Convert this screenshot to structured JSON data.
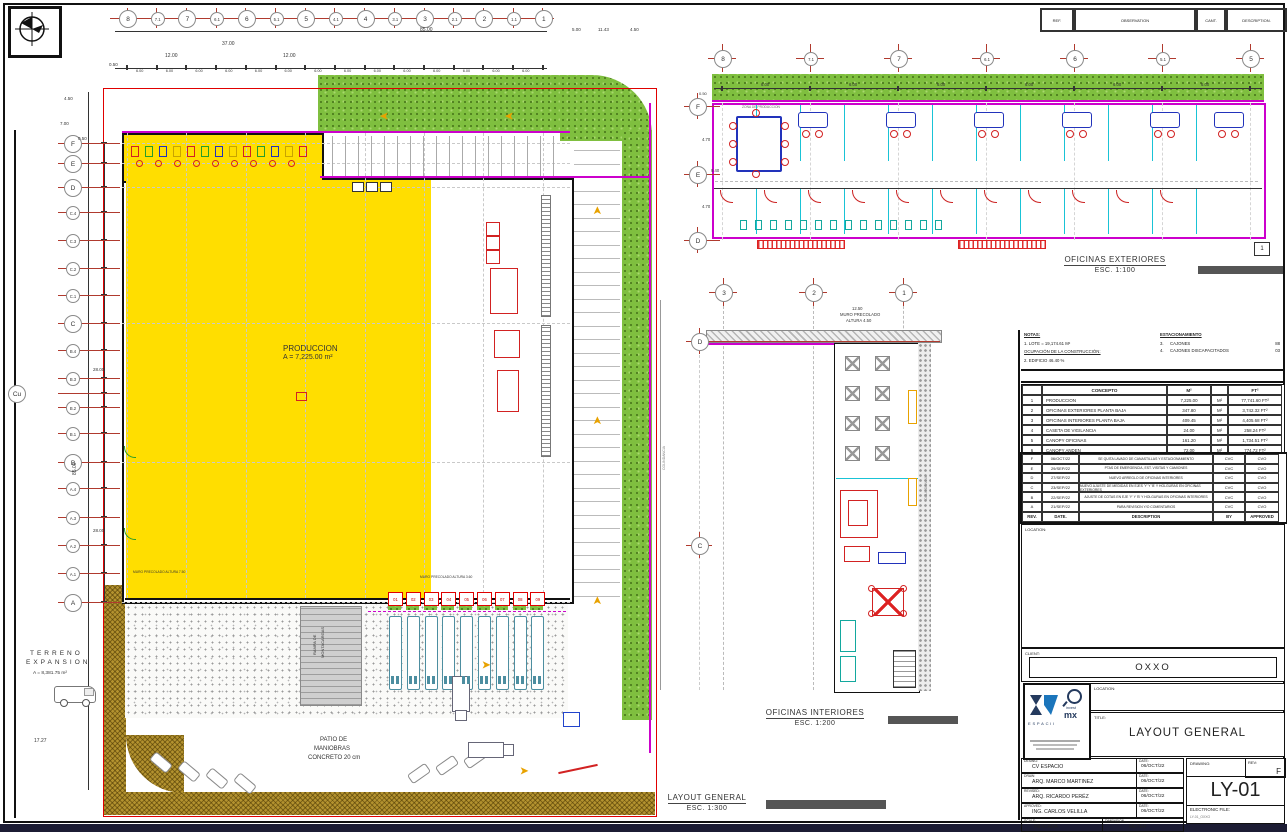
{
  "colors": {
    "production_yellow": "#ffde00",
    "landscape_green": "#7fbf3f",
    "road_brown": "#b3922f",
    "line_red": "#b03a2e",
    "wall_magenta": "#cc00cc",
    "partition_cyan": "#19c3d6",
    "furniture_blue": "#2233bb",
    "furniture_red": "#d22222",
    "bottom_bar": "#1c1c34"
  },
  "ref_header": {
    "ref": "REF.",
    "observation": "OBSERVATION",
    "cant": "CANT.",
    "description": "DESCRIPTION."
  },
  "plans": {
    "layout": {
      "title": "LAYOUT GENERAL",
      "scale": "ESC. 1:300"
    },
    "exterior": {
      "title": "OFICINAS EXTERIORES",
      "scale": "ESC. 1:100",
      "marker": "1"
    },
    "interior": {
      "title": "OFICINAS INTERIORES",
      "scale": "ESC. 1:200"
    }
  },
  "grids": {
    "layout_top": [
      "8",
      "7.1",
      "7",
      "6.1",
      "6",
      "5.1",
      "5",
      "4.1",
      "4",
      "3.1",
      "3",
      "2.1",
      "2",
      "1.1",
      "1"
    ],
    "layout_left": [
      "F",
      "E",
      "D",
      "C.4",
      "C.3",
      "C.2",
      "C.1",
      "C",
      "B.4",
      "B.3",
      "Cu",
      "B.2",
      "B.1",
      "B",
      "A.4",
      "A.3",
      "A.2",
      "A.1",
      "A"
    ],
    "exterior_top": [
      "8",
      "7.1",
      "7",
      "6.1",
      "6",
      "5.1",
      "5"
    ],
    "exterior_left": [
      "F",
      "E",
      "D"
    ],
    "interior_top": [
      "3",
      "2",
      "1"
    ],
    "interior_left": [
      "D",
      "C"
    ]
  },
  "docks": [
    "01",
    "02",
    "03",
    "04",
    "05",
    "06",
    "07",
    "08",
    "09"
  ],
  "dims": {
    "bay": "6.00"
  },
  "annotations": [
    {
      "t": "PRODUCCION",
      "x": 283,
      "y": 344,
      "s": 8
    },
    {
      "t": "A = 7,225.00 m²",
      "x": 283,
      "y": 354,
      "s": 7
    },
    {
      "t": "TERRENO",
      "x": 30,
      "y": 650,
      "s": 6.5,
      "sp": 3
    },
    {
      "t": "EXPANSION",
      "x": 26,
      "y": 659,
      "s": 6.5,
      "sp": 3
    },
    {
      "t": "A = 8,381.75 m²",
      "x": 33,
      "y": 671,
      "s": 4.8
    },
    {
      "t": "PATIO DE",
      "x": 320,
      "y": 737,
      "s": 6
    },
    {
      "t": "MANIOBRAS",
      "x": 314,
      "y": 746,
      "s": 6
    },
    {
      "t": "CONCRETO 20 cm",
      "x": 308,
      "y": 755,
      "s": 6
    },
    {
      "t": "RAMPA DE",
      "x": 312,
      "y": 655,
      "s": 4,
      "r": -90
    },
    {
      "t": "MONTACARGAS",
      "x": 320,
      "y": 658,
      "s": 4,
      "r": -90
    },
    {
      "t": "85.00",
      "x": 420,
      "y": 27,
      "s": 5
    },
    {
      "t": "37.00",
      "x": 222,
      "y": 41,
      "s": 5
    },
    {
      "t": "12.00",
      "x": 165,
      "y": 53,
      "s": 5
    },
    {
      "t": "12.00",
      "x": 283,
      "y": 53,
      "s": 5
    },
    {
      "t": "0.50",
      "x": 109,
      "y": 62,
      "s": 4.5
    },
    {
      "t": "5.00",
      "x": 572,
      "y": 27,
      "s": 4.5
    },
    {
      "t": "11.43",
      "x": 598,
      "y": 27,
      "s": 4.5
    },
    {
      "t": "4.50",
      "x": 630,
      "y": 27,
      "s": 4.5
    },
    {
      "t": "4.50",
      "x": 64,
      "y": 96,
      "s": 4.5
    },
    {
      "t": "7.00",
      "x": 60,
      "y": 121,
      "s": 4.5
    },
    {
      "t": "0.50",
      "x": 78,
      "y": 136,
      "s": 4.5
    },
    {
      "t": "85.00",
      "x": 72,
      "y": 475,
      "s": 5,
      "r": -90
    },
    {
      "t": "28.00",
      "x": 93,
      "y": 367,
      "s": 4.5
    },
    {
      "t": "28.00",
      "x": 93,
      "y": 528,
      "s": 4.5
    },
    {
      "t": "17.27",
      "x": 34,
      "y": 738,
      "s": 5
    },
    {
      "t": "MURO PRECOLADO ALTURA 7.50",
      "x": 133,
      "y": 570,
      "s": 3.3
    },
    {
      "t": "MURO PRECOLADO ALTURA 3.60",
      "x": 420,
      "y": 575,
      "s": 3.3
    },
    {
      "t": "0.50",
      "x": 699,
      "y": 91,
      "s": 4
    },
    {
      "t": "4.70",
      "x": 702,
      "y": 137,
      "s": 4.2
    },
    {
      "t": "9.40",
      "x": 711,
      "y": 168,
      "s": 4.2
    },
    {
      "t": "4.70",
      "x": 702,
      "y": 204,
      "s": 4.2
    },
    {
      "t": "ZONA DE PRODUCCION",
      "x": 742,
      "y": 105,
      "s": 3.3,
      "c": "#666"
    },
    {
      "t": "12.50",
      "x": 852,
      "y": 306,
      "s": 4.2
    },
    {
      "t": "MURO PRECOLADO",
      "x": 840,
      "y": 312,
      "s": 4.2
    },
    {
      "t": "ALTURA 4.50",
      "x": 846,
      "y": 318,
      "s": 4.2
    },
    {
      "t": "COLINDANCIA",
      "x": 662,
      "y": 470,
      "s": 3.5,
      "r": -90,
      "c": "#888"
    },
    {
      "t": "COLINDANCIA",
      "x": 924,
      "y": 500,
      "s": 3.5,
      "r": -90,
      "c": "#888"
    }
  ],
  "notes": {
    "title": "NOTAS:",
    "line1": "1.   LOTE = 19,174.61 M²",
    "line2": "OCUPACIÓN DE LA CONSTRUCCIÓN:",
    "line3": "2.   EDIFICIO 46.40 %"
  },
  "parking": {
    "title": "ESTACIONAMIENTO",
    "rows": [
      {
        "n": "3.",
        "label": "CAJONES",
        "qty": "88"
      },
      {
        "n": "4.",
        "label": "CAJONES DISCAPACITADOS",
        "qty": "03"
      }
    ]
  },
  "concept_table": {
    "col_concepto": "CONCEPTO",
    "col_m2": "M²",
    "col_ft2": "FT²",
    "rows": [
      [
        "1",
        "PRODUCCION",
        "7,225.00",
        "M²",
        "77,741.60",
        "FT²"
      ],
      [
        "2",
        "OFICINAS EXTERIORES PLANTA BAJA",
        "347.80",
        "M²",
        "3,742.32",
        "FT²"
      ],
      [
        "3",
        "OFICINAS INTERIORES PLANTA BAJA",
        "409.45",
        "M²",
        "4,405.68",
        "FT²"
      ],
      [
        "4",
        "CASETA DE VIGILANCIA",
        "24.00",
        "M²",
        "258.24",
        "FT²"
      ],
      [
        "5",
        "CANOPY OFICINAS",
        "161.20",
        "M²",
        "1,734.51",
        "FT²"
      ],
      [
        "6",
        "CANOPY ANDEN",
        "72.00",
        "M²",
        "774.72",
        "FT²"
      ]
    ]
  },
  "revision_table": {
    "rows": [
      [
        "F",
        "06/OCT/22",
        "SE QUITA LAVADO DE CANASTILLAS Y ESTACIONAMIENTO",
        "CVC",
        "CVO"
      ],
      [
        "E",
        "29/SEP/22",
        "PTAS DE EMERGENCIA, EST. VISITAS Y CAMIONES",
        "CVC",
        "CVO"
      ],
      [
        "D",
        "27/SEP/22",
        "NUEVO ARREGLO DE OFICINAS INTERIORES",
        "CVC",
        "CVO"
      ],
      [
        "C",
        "23/SEP/22",
        "NUEVO AJUSTE DE MEDIDAS EN EJES 'Y' Y 'B' Y HOLGURAS EN OFICINAS EXTERIORES",
        "CVC",
        "CVO"
      ],
      [
        "B",
        "22/SEP/22",
        "AJUSTE DE COTAS EN EJE 'Y' Y 'B' Y HOLGURAS EN OFICINAS INTERIORES",
        "CVC",
        "CVO"
      ],
      [
        "A",
        "21/SEP/22",
        "PARA REVISION Y/O COMENTARIOS",
        "CVC",
        "CVO"
      ]
    ],
    "footer": [
      "REV.",
      "DATE.",
      "DESCRIPTION",
      "BY",
      "APPROVED"
    ]
  },
  "title_block": {
    "client_label": "CLIENT:",
    "client": "OXXO",
    "location_label": "LOCATION:",
    "title_label": "TITLE:",
    "title": "LAYOUT GENERAL",
    "rows": [
      {
        "label": "DESING:",
        "value": "CV ESPACIO",
        "date_label": "DATE:",
        "date": "06/OCT/22"
      },
      {
        "label": "DRAW:",
        "value": "ARQ. MARCO MARTINEZ",
        "date_label": "DATE:",
        "date": "06/OCT/22"
      },
      {
        "label": "REVISED:",
        "value": "ARQ. RICARDO PERÉZ",
        "date_label": "DATE:",
        "date": "06/OCT/22"
      },
      {
        "label": "APROVED:",
        "value": "ING. CARLOS VELILLA",
        "date_label": "DATE:",
        "date": "06/OCT/22"
      }
    ],
    "scale_label": "SCALE:",
    "scale": "INDICADA",
    "dimension_label": "DIMENSION",
    "dimension": "METER",
    "drawing_label": "DRAWING:",
    "rev_label": "REV:",
    "rev": "F",
    "number": "LY-01",
    "efile_label": "ELECTRONIC FILE:",
    "efile": "LY-01_OXXO"
  },
  "logo": {
    "espacii": "ESPACII",
    "invest": "invest",
    "mx": "mx"
  }
}
